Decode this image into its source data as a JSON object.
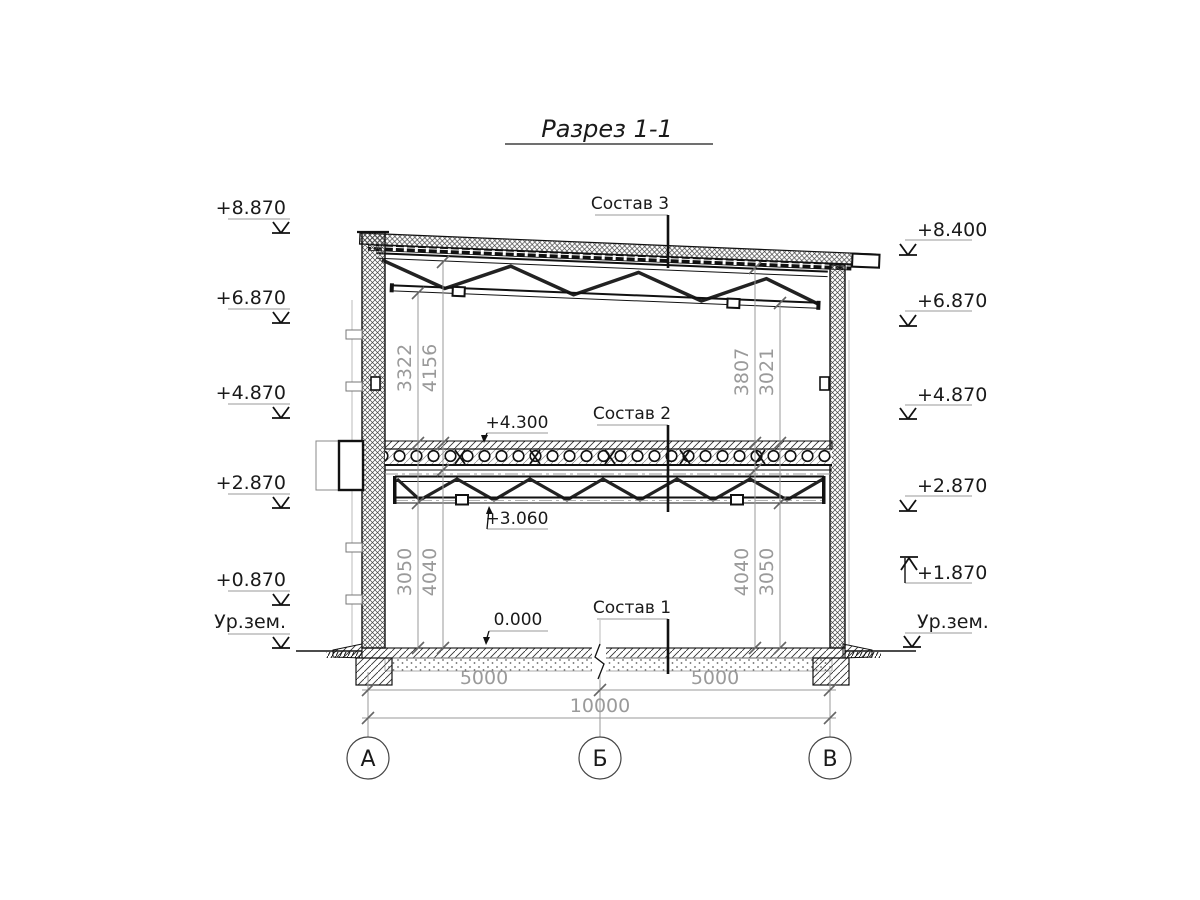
{
  "title": "Разрез 1-1",
  "levels_left": [
    "+8.870",
    "+6.870",
    "+4.870",
    "+2.870",
    "+0.870",
    "Ур.зем."
  ],
  "levels_right": [
    "+8.400",
    "+6.870",
    "+4.870",
    "+2.870",
    "+1.870",
    "Ур.зем."
  ],
  "layer_labels": [
    "Состав 3",
    "Состав 2",
    "Состав 1"
  ],
  "spot_marks": [
    "+4.300",
    "+3.060",
    "0.000"
  ],
  "vdims": {
    "upper_left": [
      "3322",
      "4156"
    ],
    "upper_right": [
      "3807",
      "3021"
    ],
    "lower_left": [
      "3050",
      "4040"
    ],
    "lower_right": [
      "4040",
      "3050"
    ]
  },
  "hdims": {
    "spans": [
      "5000",
      "5000"
    ],
    "total": "10000"
  },
  "axes": [
    "А",
    "Б",
    "В"
  ],
  "colors": {
    "ink": "#1a1a1a",
    "dim_gray": "#9a9a9a"
  }
}
